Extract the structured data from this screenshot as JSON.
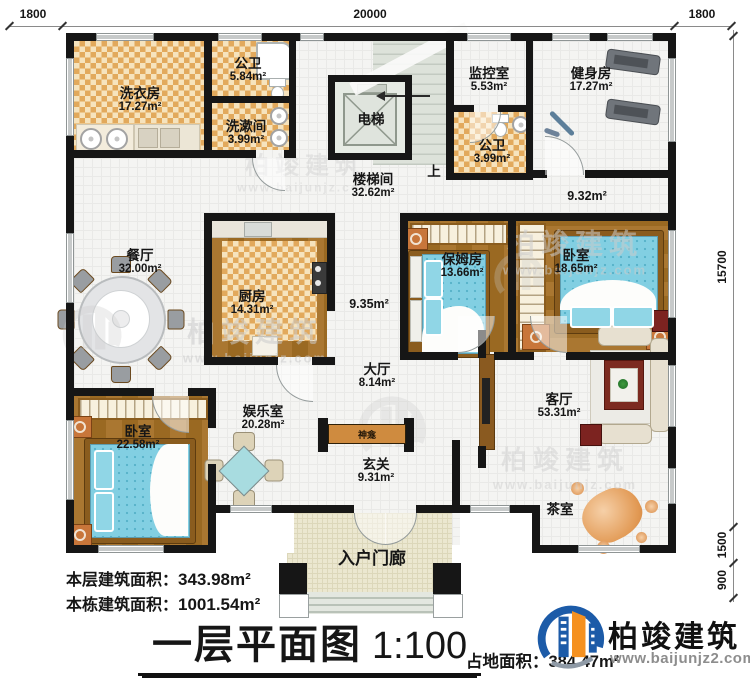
{
  "header_dimensions": {
    "left": "1800",
    "center": "20000",
    "right": "1800"
  },
  "side_dimensions": {
    "height": "15700",
    "tea": "1500",
    "porch": "900"
  },
  "rooms": {
    "laundry": {
      "name": "洗衣房",
      "area": "17.27m²"
    },
    "bath1": {
      "name": "公卫",
      "area": "5.84m²"
    },
    "washroom": {
      "name": "洗漱间",
      "area": "3.99m²"
    },
    "elevator": {
      "name": "电梯"
    },
    "stairwell": {
      "name": "楼梯间",
      "area": "32.62m²"
    },
    "monitor": {
      "name": "监控室",
      "area": "5.53m²"
    },
    "bath2": {
      "name": "公卫",
      "area": "3.99m²"
    },
    "gym": {
      "name": "健身房",
      "area": "17.27m²"
    },
    "corridor_right": {
      "area": "9.32m²"
    },
    "dining": {
      "name": "餐厅",
      "area": "32.00m²"
    },
    "kitchen": {
      "name": "厨房",
      "area": "14.31m²"
    },
    "corridor_mid": {
      "area": "9.35m²"
    },
    "nanny": {
      "name": "保姆房",
      "area": "13.66m²"
    },
    "bedroom_right": {
      "name": "卧室",
      "area": "18.65m²"
    },
    "hall": {
      "name": "大厅",
      "area": "8.14m²"
    },
    "entertainment": {
      "name": "娱乐室",
      "area": "20.28m²"
    },
    "shrine": {
      "name": "神龛"
    },
    "foyer": {
      "name": "玄关",
      "area": "9.31m²"
    },
    "living": {
      "name": "客厅",
      "area": "53.31m²"
    },
    "tea": {
      "name": "茶室"
    },
    "bedroom_left": {
      "name": "卧室",
      "area": "22.58m²"
    },
    "porch": {
      "name": "入户门廊"
    },
    "up": "上"
  },
  "footer": {
    "floor_area_label": "本层建筑面积：",
    "floor_area_value": "343.98m²",
    "building_area_label": "本栋建筑面积：",
    "building_area_value": "1001.54m²",
    "title": "一层平面图",
    "scale": "1:100",
    "land_area_label": "占地面积：",
    "land_area_value": "384.47m²"
  },
  "branding": {
    "watermark_name": "柏竣建筑",
    "watermark_url": "www.baijunjz.com",
    "logo_name": "柏竣建筑",
    "logo_url": "www.baijunjz2.com"
  },
  "colors": {
    "wall": "#161616",
    "checker": "#e2a95c",
    "wood": "#a06e2a",
    "bed_teal": "#82cfe2",
    "porch": "#ebe7d0",
    "shrine_bar": "#cf8b3f",
    "logo_blue": "#1c5ba8",
    "logo_orange": "#f59120",
    "watermark_grey": "#cccccc"
  }
}
